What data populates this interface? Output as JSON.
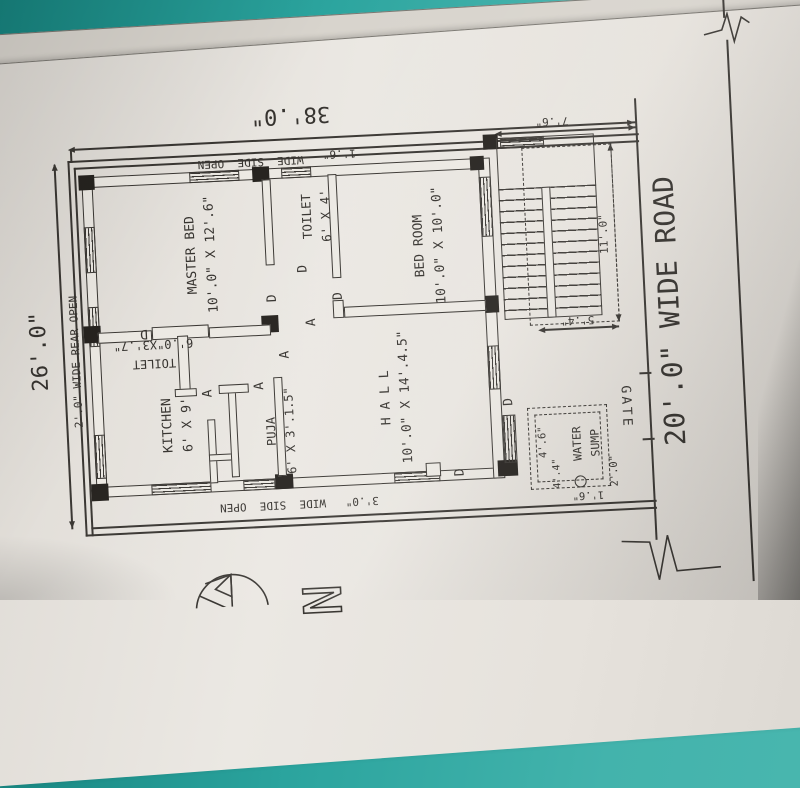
{
  "scene": {
    "description": "Photograph of a hand-drafted CAD house floor plan sheet lying rotated on a teal table"
  },
  "colors": {
    "table_teal": "#2ba49e",
    "paper": "#e9e6e0",
    "ink": "#3a3733",
    "pen_gold": "#ab8c3f"
  },
  "site": {
    "height_dim": "38'.0\"",
    "width_dim": "26'.0\"",
    "rear_margin": "2'.0\" WIDE REAR OPEN",
    "right_margin_width": "1'.6\"",
    "right_margin_label": "WIDE  SIDE  OPEN",
    "left_margin": "3'.0\"   WIDE  SIDE  OPEN"
  },
  "road": {
    "label": "20'.0\" WIDE ROAD"
  },
  "gate": {
    "label": "GATE",
    "width_dim": "2'.0\"",
    "pit_dim": "1'.6\""
  },
  "stair": {
    "width_dim": "7'.6\"",
    "length_dim": "11'.0\"",
    "yard_dim": "5'.4\""
  },
  "water_sump": {
    "line1": "WATER",
    "line2": "SUMP",
    "dim_w": "4'.6\"",
    "dim_h": "4'.4\""
  },
  "rooms": {
    "master": {
      "name": "MASTER BED",
      "dims": "10'.0\" X 12'.6\""
    },
    "toilet_attached": {
      "name": "TOILET",
      "dims": "6' X 4'"
    },
    "bedroom": {
      "name": "BED ROOM",
      "dims": "10'.0\" X 10'.0\""
    },
    "toilet_common": {
      "name": "TOILET",
      "dims": "6'.0\"X3'.7\""
    },
    "kitchen": {
      "name": "KITCHEN",
      "dims": "6' X 9'"
    },
    "puja": {
      "name": "PUJA",
      "dims": "6' X 3'.1.5\""
    },
    "hall": {
      "name": "H A L L",
      "dims": "10'.0\" X 14'.4.5\""
    }
  },
  "markers": {
    "door": "D",
    "arch": "A",
    "north": "N"
  }
}
